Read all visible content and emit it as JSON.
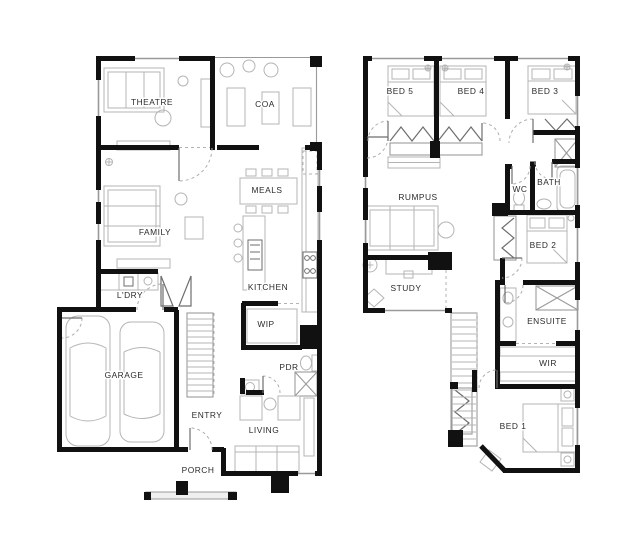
{
  "document": {
    "type": "floor-plan",
    "background_color": "#ffffff",
    "wall_color": "#111111",
    "furniture_color": "#b4b4b4",
    "label_color": "#2b2b2b"
  },
  "ground_floor": {
    "rooms": [
      {
        "label": "THEATRE"
      },
      {
        "label": "COA"
      },
      {
        "label": "MEALS"
      },
      {
        "label": "FAMILY"
      },
      {
        "label": "KITCHEN"
      },
      {
        "label": "L'DRY"
      },
      {
        "label": "WIP"
      },
      {
        "label": "GARAGE"
      },
      {
        "label": "PDR"
      },
      {
        "label": "ENTRY"
      },
      {
        "label": "LIVING"
      },
      {
        "label": "PORCH"
      }
    ]
  },
  "first_floor": {
    "rooms": [
      {
        "label": "BED 5"
      },
      {
        "label": "BED 4"
      },
      {
        "label": "BED 3"
      },
      {
        "label": "RUMPUS"
      },
      {
        "label": "WC"
      },
      {
        "label": "BATH"
      },
      {
        "label": "BED 2"
      },
      {
        "label": "STUDY"
      },
      {
        "label": "ENSUITE"
      },
      {
        "label": "WIR"
      },
      {
        "label": "BED 1"
      }
    ]
  }
}
